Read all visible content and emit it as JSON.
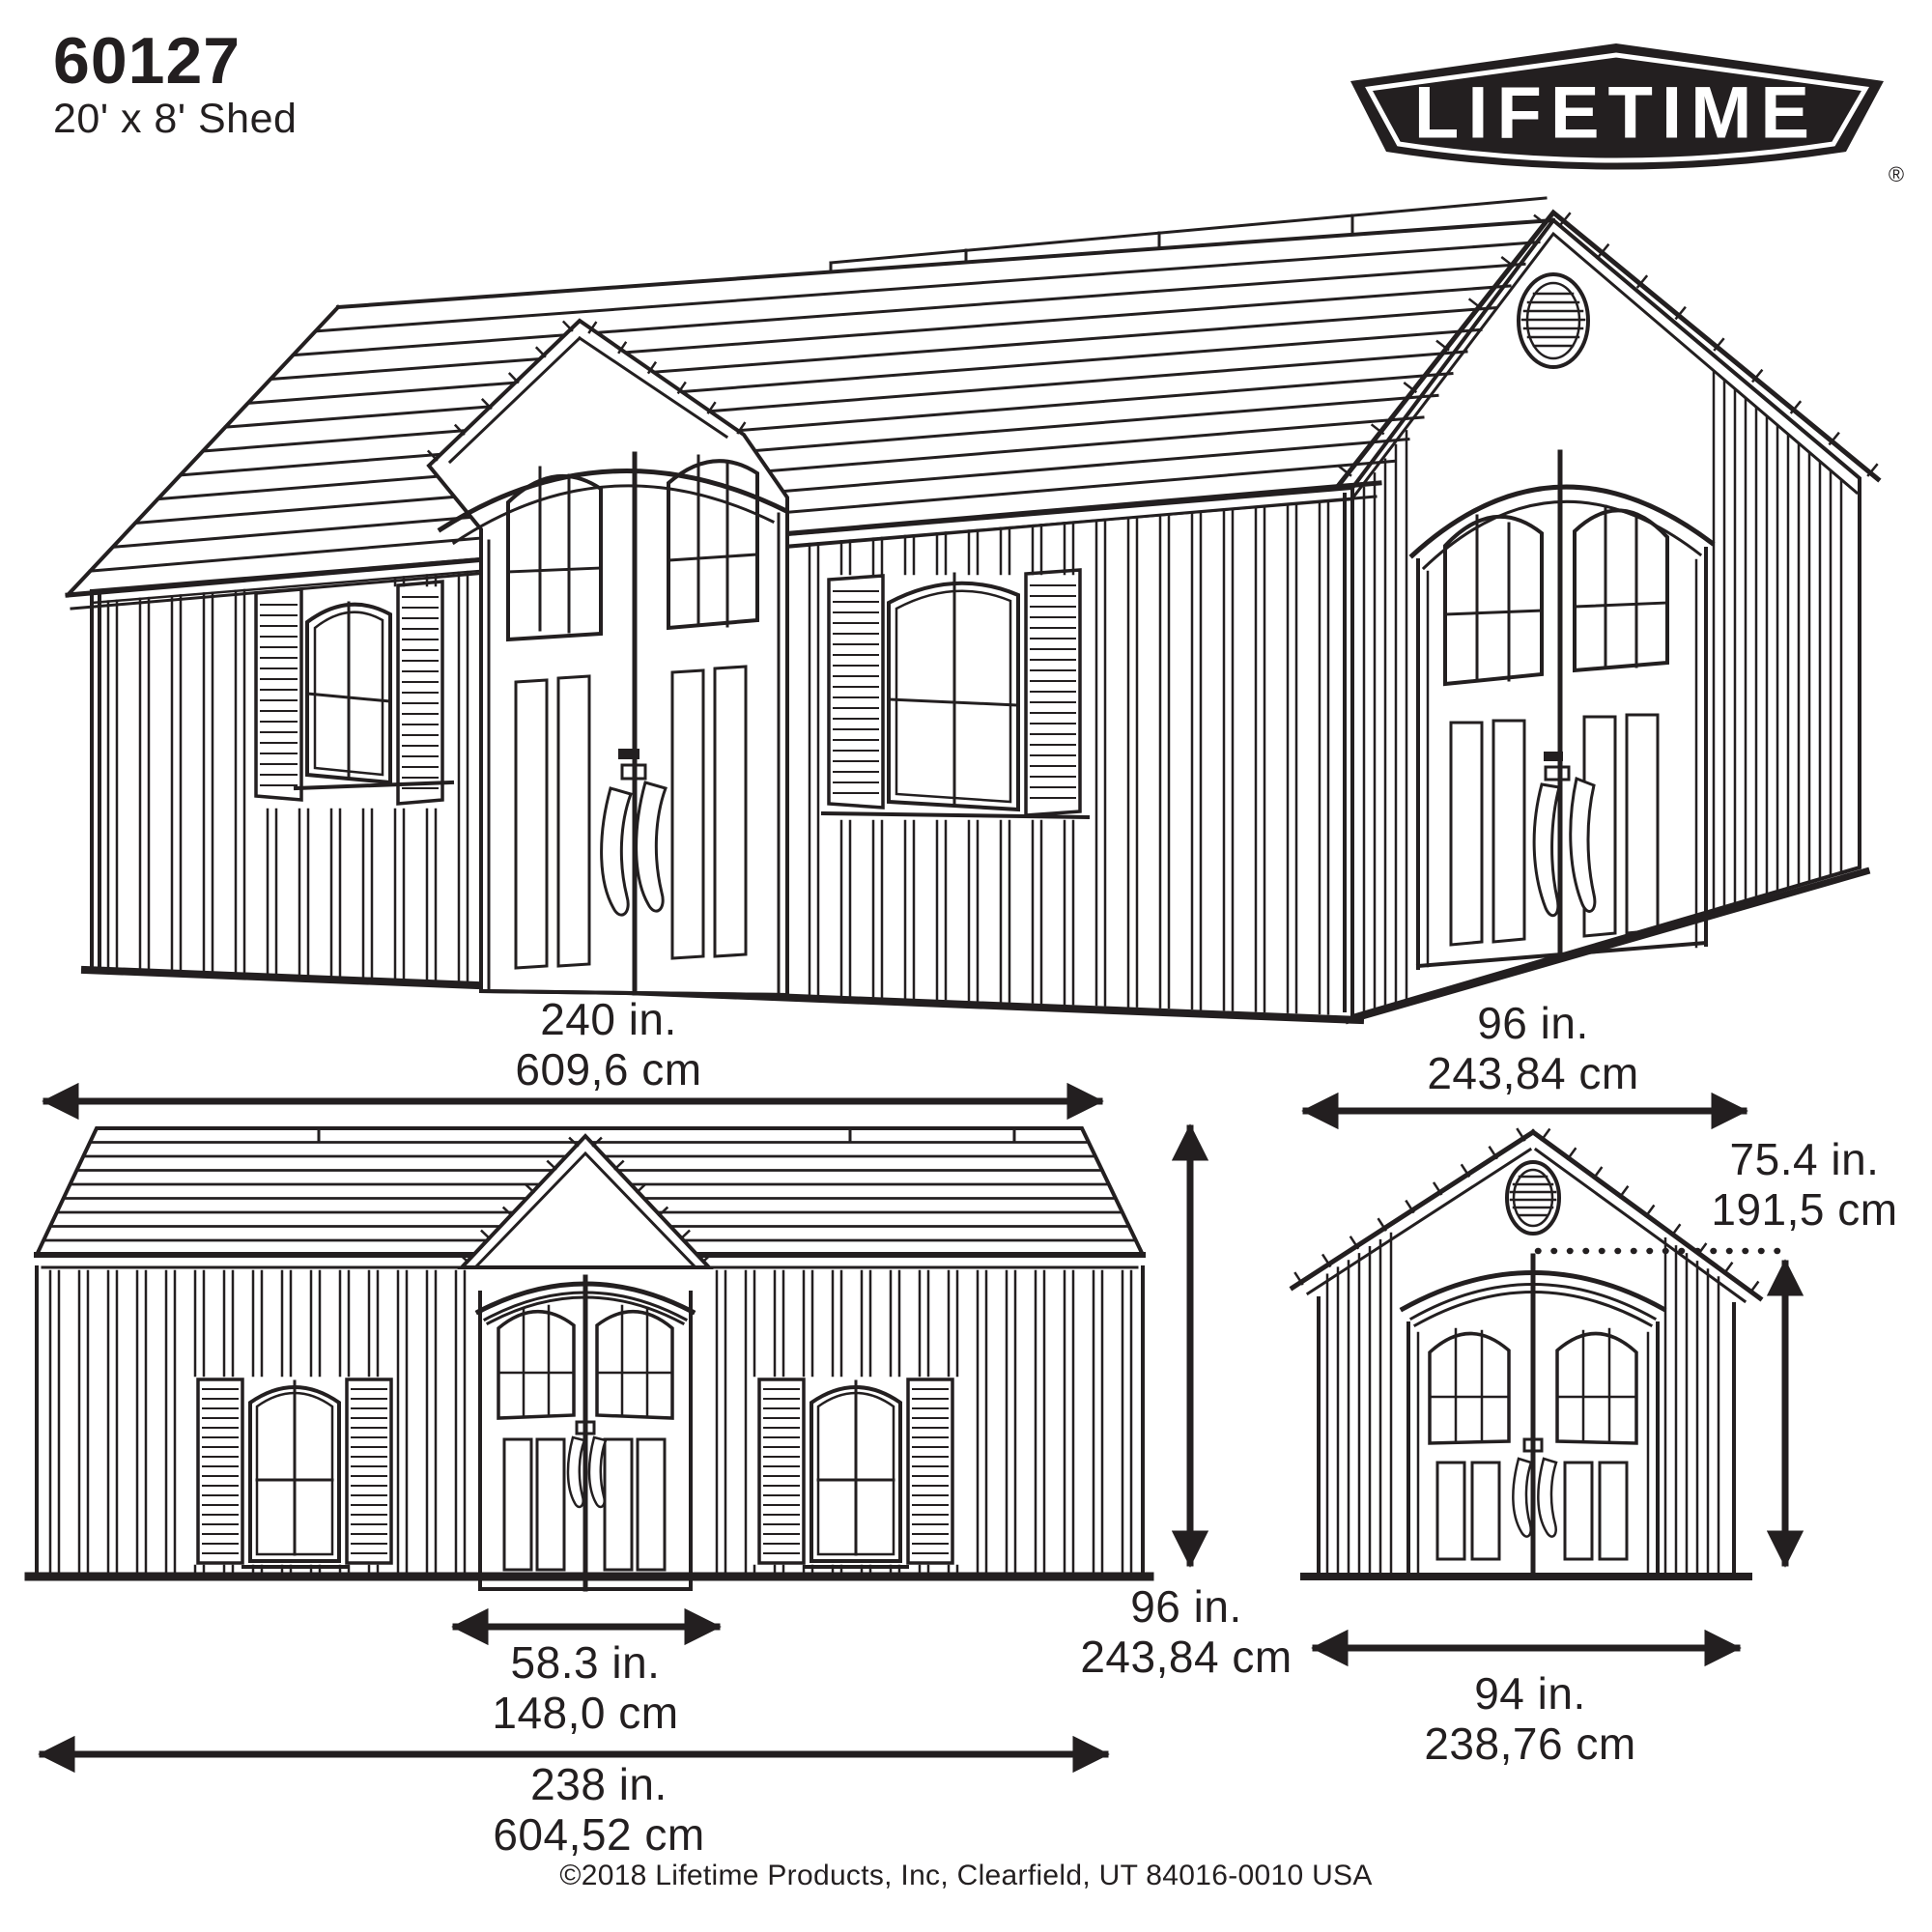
{
  "colors": {
    "ink": "#231f20",
    "background": "#ffffff"
  },
  "header": {
    "model": "60127",
    "subtitle": "20' x 8' Shed"
  },
  "logo": {
    "text": "LIFETIME",
    "registered": "®"
  },
  "dimensions": {
    "roof_length": {
      "in": "240 in.",
      "cm": "609,6 cm"
    },
    "side_width": {
      "in": "96 in.",
      "cm": "243,84 cm"
    },
    "eave_height": {
      "in": "75.4 in.",
      "cm": "191,5 cm"
    },
    "peak_height": {
      "in": "96 in.",
      "cm": "243,84 cm"
    },
    "door_width": {
      "in": "58.3 in.",
      "cm": "148,0 cm"
    },
    "base_length": {
      "in": "238 in.",
      "cm": "604,52 cm"
    },
    "side_base_width": {
      "in": "94 in.",
      "cm": "238,76 cm"
    }
  },
  "footer": {
    "copyright": "©2018 Lifetime Products, Inc, Clearfield, UT 84016-0010 USA"
  }
}
